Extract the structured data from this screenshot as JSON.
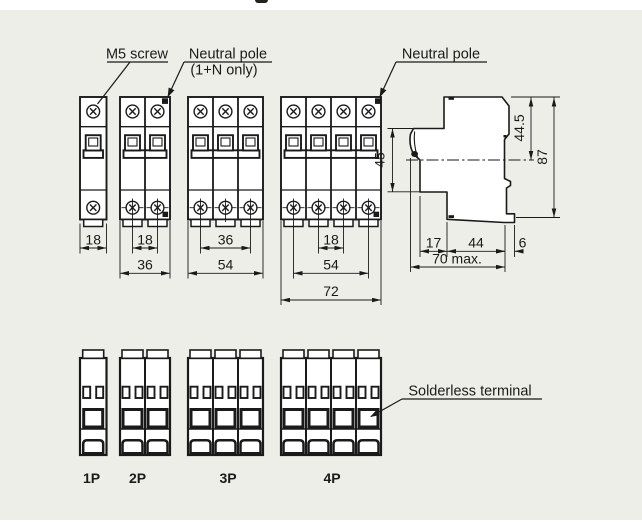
{
  "labels": {
    "m5_screw": "M5 screw",
    "neutral_pole_2p_line1": "Neutral pole",
    "neutral_pole_2p_line2": "(1+N only)",
    "neutral_pole_4p": "Neutral pole",
    "solderless_terminal": "Solderless terminal"
  },
  "front_dims": {
    "p1_width_mm": "18",
    "p2_pole_pitch_mm": "18",
    "p2_width_mm": "36",
    "p3_outer_pitch_mm": "36",
    "p3_width_mm": "54",
    "p4_pole_pitch_mm": "18",
    "p4_outer_pitch_mm": "54",
    "p4_width_mm": "72"
  },
  "side_dims": {
    "front_height_mm": "45",
    "upper_height_mm": "44.5",
    "total_height_mm": "87",
    "front_depth_mm": "17",
    "body_depth_mm": "44",
    "rear_depth_mm": "6",
    "total_depth_mm": "70 max."
  },
  "pole_labels": [
    "1P",
    "2P",
    "3P",
    "4P"
  ],
  "colors": {
    "panel_background": "#eeeee9",
    "line": "#1a1a1a",
    "body_fill": "#ffffff"
  }
}
